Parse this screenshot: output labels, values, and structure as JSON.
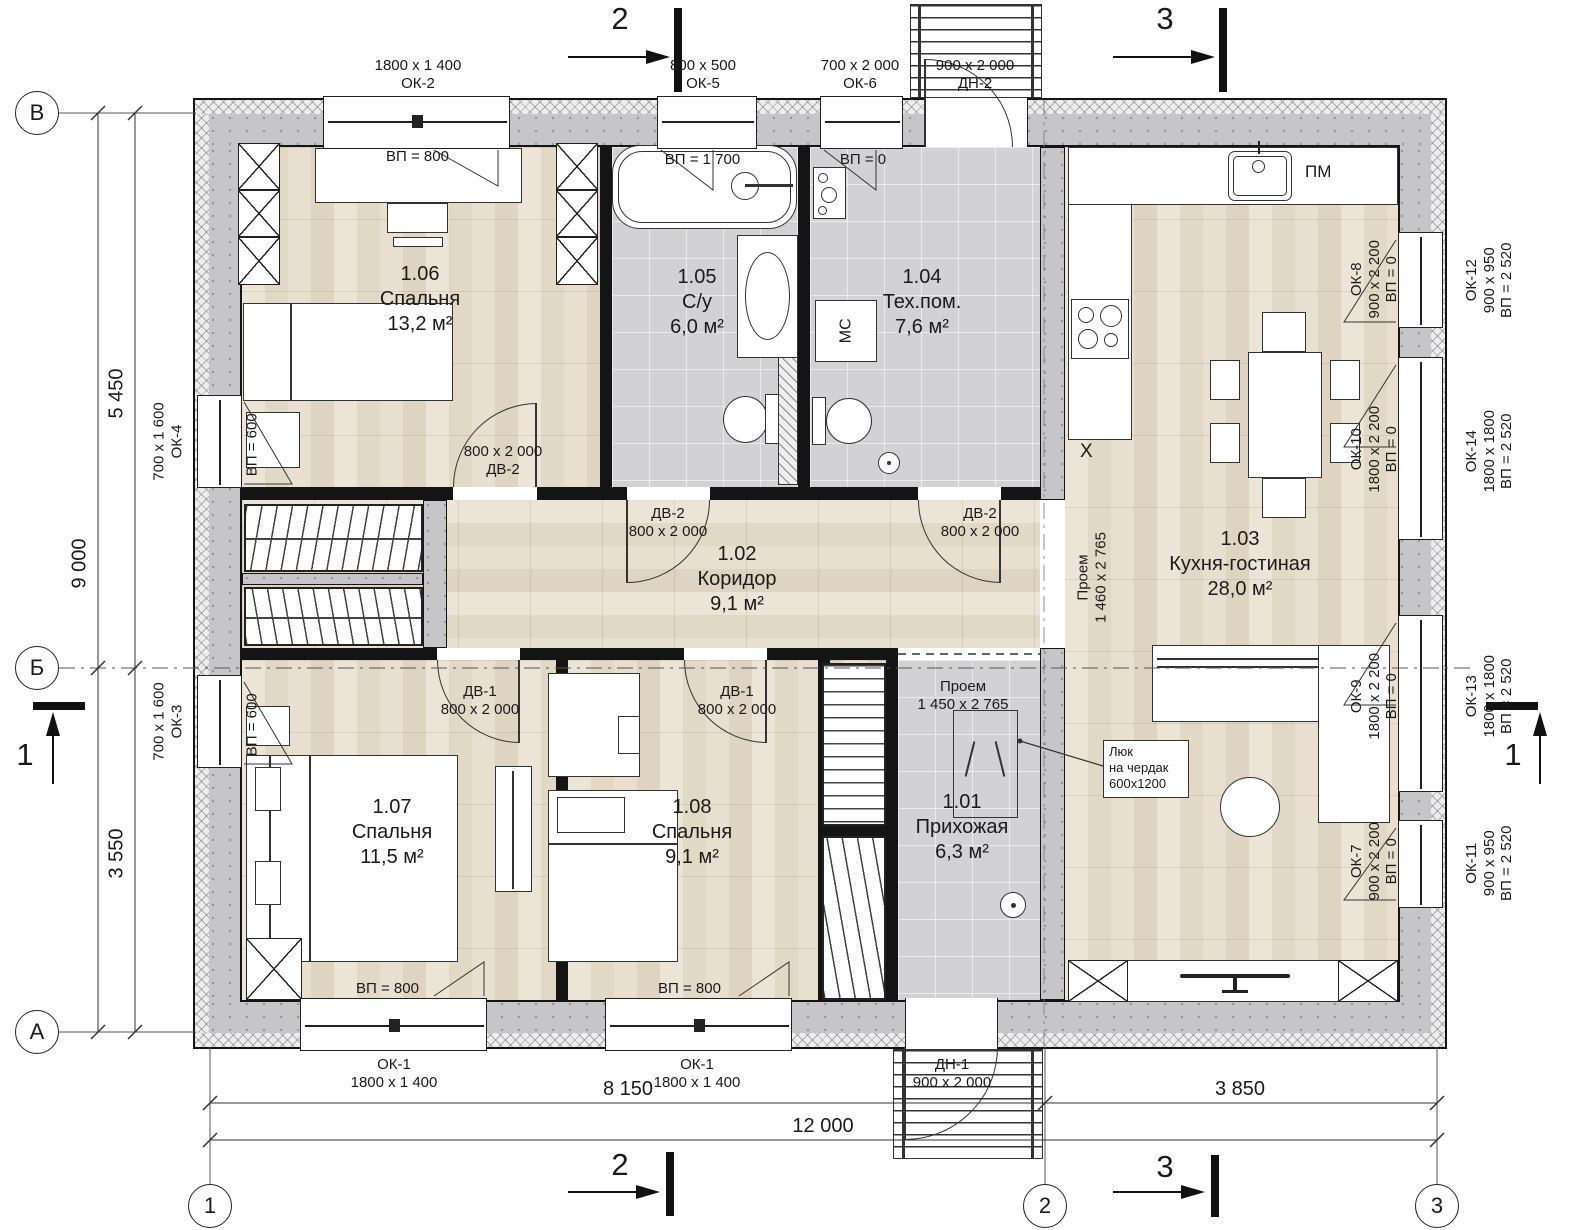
{
  "axes": {
    "b": "В",
    "mid": "Б",
    "a": "А",
    "c1": "1",
    "c2": "2",
    "c3": "3"
  },
  "dims": {
    "left_top": "5 450",
    "left_total": "9 000",
    "left_bottom": "3 550",
    "bottom_left": "8 150",
    "bottom_right": "3 850",
    "bottom_total": "12 000"
  },
  "sections": {
    "s1": "1",
    "s2": "2",
    "s3": "3"
  },
  "rooms": [
    {
      "num": "1.06",
      "name": "Спальня",
      "area": "13,2 м²"
    },
    {
      "num": "1.05",
      "name": "С/у",
      "area": "6,0 м²"
    },
    {
      "num": "1.04",
      "name": "Тех.пом.",
      "area": "7,6 м²"
    },
    {
      "num": "1.03",
      "name": "Кухня-гостиная",
      "area": "28,0 м²"
    },
    {
      "num": "1.02",
      "name": "Коридор",
      "area": "9,1 м²"
    },
    {
      "num": "1.07",
      "name": "Спальня",
      "area": "11,5 м²"
    },
    {
      "num": "1.08",
      "name": "Спальня",
      "area": "9,1 м²"
    },
    {
      "num": "1.01",
      "name": "Прихожая",
      "area": "6,3 м²"
    }
  ],
  "top_openings": [
    {
      "size": "1800 x 1 400",
      "code": "ОК-2",
      "sill": "ВП = 800"
    },
    {
      "size": "800 x 500",
      "code": "ОК-5",
      "sill": "ВП = 1 700"
    },
    {
      "size": "700 x 2 000",
      "code": "ОК-6",
      "sill": "ВП = 0"
    },
    {
      "size": "900 x 2 000",
      "code": "ДН-2"
    }
  ],
  "bottom_openings": [
    {
      "code": "ОК-1",
      "size": "1800 x 1 400",
      "sill": "ВП = 800"
    },
    {
      "code": "ОК-1",
      "size": "1800 x 1 400",
      "sill": "ВП = 800"
    },
    {
      "code": "ДН-1",
      "size": "900 x 2 000"
    }
  ],
  "left_openings": [
    {
      "size": "700 x 1 600",
      "code": "ОК-4",
      "sill": "ВП = 600"
    },
    {
      "size": "700 x 1 600",
      "code": "ОК-3",
      "sill": "ВП = 600"
    }
  ],
  "right_openings": [
    {
      "code": "ОК-8",
      "size": "900 x 2 200",
      "sill": "ВП = 0",
      "outer_code": "ОК-12",
      "outer_size": "900 x 950",
      "outer_sill": "ВП = 2 520"
    },
    {
      "code": "ОК-10",
      "size": "1800 x 2 200",
      "sill": "ВП = 0",
      "outer_code": "ОК-14",
      "outer_size": "1800 x 1800",
      "outer_sill": "ВП = 2 520"
    },
    {
      "code": "ОК-9",
      "size": "1800 x 2 200",
      "sill": "ВП = 0",
      "outer_code": "ОК-13",
      "outer_size": "1800 x 1800",
      "outer_sill": "ВП = 2 520"
    },
    {
      "code": "ОК-7",
      "size": "900 x 2 200",
      "sill": "ВП = 0",
      "outer_code": "ОК-11",
      "outer_size": "900 x 950",
      "outer_sill": "ВП = 2 520"
    }
  ],
  "doors": {
    "dv1": {
      "code": "ДВ-1",
      "size": "800 x 2 000"
    },
    "dv2": {
      "code": "ДВ-2",
      "size": "800 x 2 000"
    }
  },
  "passages": {
    "corridor_kitchen": {
      "label": "Проем",
      "size": "1 460 x 2 765"
    },
    "hall_corridor": {
      "label": "Проем",
      "size": "1 450 x 2 765"
    }
  },
  "attic": {
    "l1": "Люк",
    "l2": "на чердак",
    "l3": "600x1200"
  },
  "appliances": {
    "dishwasher": "ПМ",
    "washer": "МС",
    "fridge": "Х"
  }
}
